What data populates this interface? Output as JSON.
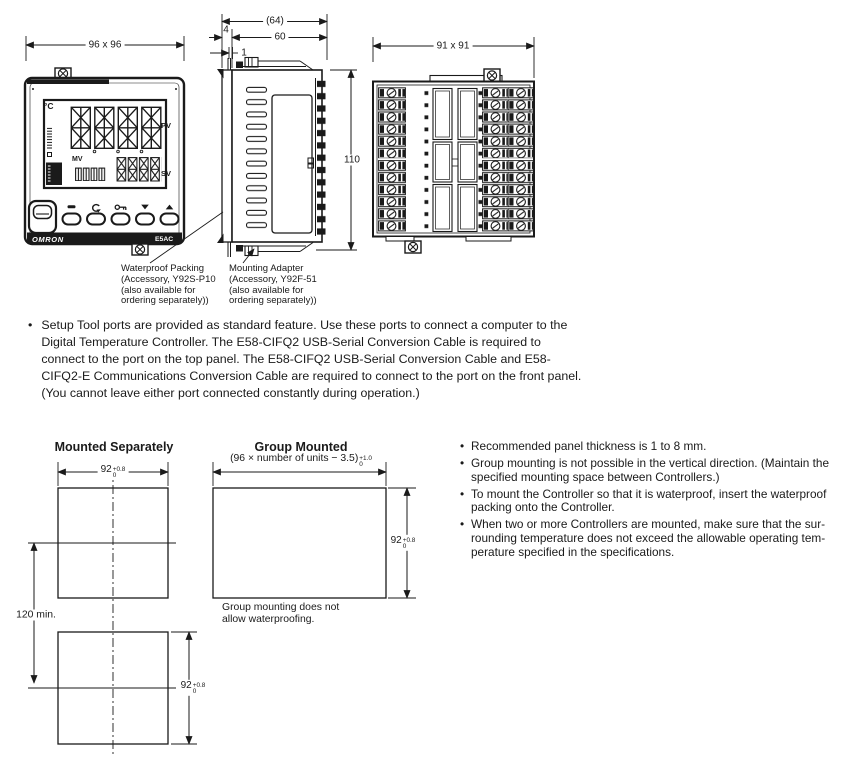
{
  "drawing": {
    "front": {
      "dim": "96 x 96",
      "unit": "°C",
      "pv": "PV",
      "mv": "MV",
      "sv": "SV",
      "brand": "OMRON",
      "model": "E5AC"
    },
    "side": {
      "dim_overall": "(64)",
      "dim_body": "60",
      "dim_bezel": "4",
      "dim_gap": "1",
      "dim_height": "110"
    },
    "rear": {
      "dim": "91 x 91"
    },
    "callout_waterproof": "Waterproof Packing\n(Accessory, Y92S-P10\n(also available for\nordering separately))",
    "callout_adapter": "Mounting Adapter\n(Accessory, Y92F-51\n(also available for\nordering separately))"
  },
  "setup_note": {
    "bullet": "•",
    "text": "Setup Tool ports are provided as standard feature. Use these ports to connect a computer to the\nDigital Temperature Controller. The E58-CIFQ2 USB-Serial Conversion Cable is required to\nconnect to the port on the top panel. The E58-CIFQ2 USB-Serial Conversion Cable and E58-\nCIFQ2-E Communications Conversion Cable are required to connect to the port on the front panel.\n(You cannot leave either port connected constantly during operation.)"
  },
  "mounting": {
    "separate": {
      "title": "Mounted Separately",
      "width": {
        "value": "92",
        "plus": "+0.8",
        "minus": "0"
      },
      "height": {
        "value": "92",
        "plus": "+0.8",
        "minus": "0"
      },
      "spacing": "120 min."
    },
    "group": {
      "title": "Group Mounted",
      "formula": {
        "value": "(96 × number of units − 3.5)",
        "plus": "+1.0",
        "minus": "0"
      },
      "height": {
        "value": "92",
        "plus": "+0.8",
        "minus": "0"
      },
      "caption": "Group mounting does not\nallow waterproofing."
    },
    "notes": [
      "Recommended panel thickness is 1 to 8 mm.",
      "Group mounting is not possible in the vertical direction. (Maintain the\nspecified mounting space between Controllers.)",
      "To mount the Controller so that it is waterproof, insert the waterproof\npacking onto the Controller.",
      "When two or more Controllers are mounted, make sure that the sur-\nrounding temperature does not exceed the allowable operating tem-\nperature specified in the specifications."
    ]
  },
  "colors": {
    "ink": "#1a1a1a",
    "paper": "#ffffff"
  }
}
